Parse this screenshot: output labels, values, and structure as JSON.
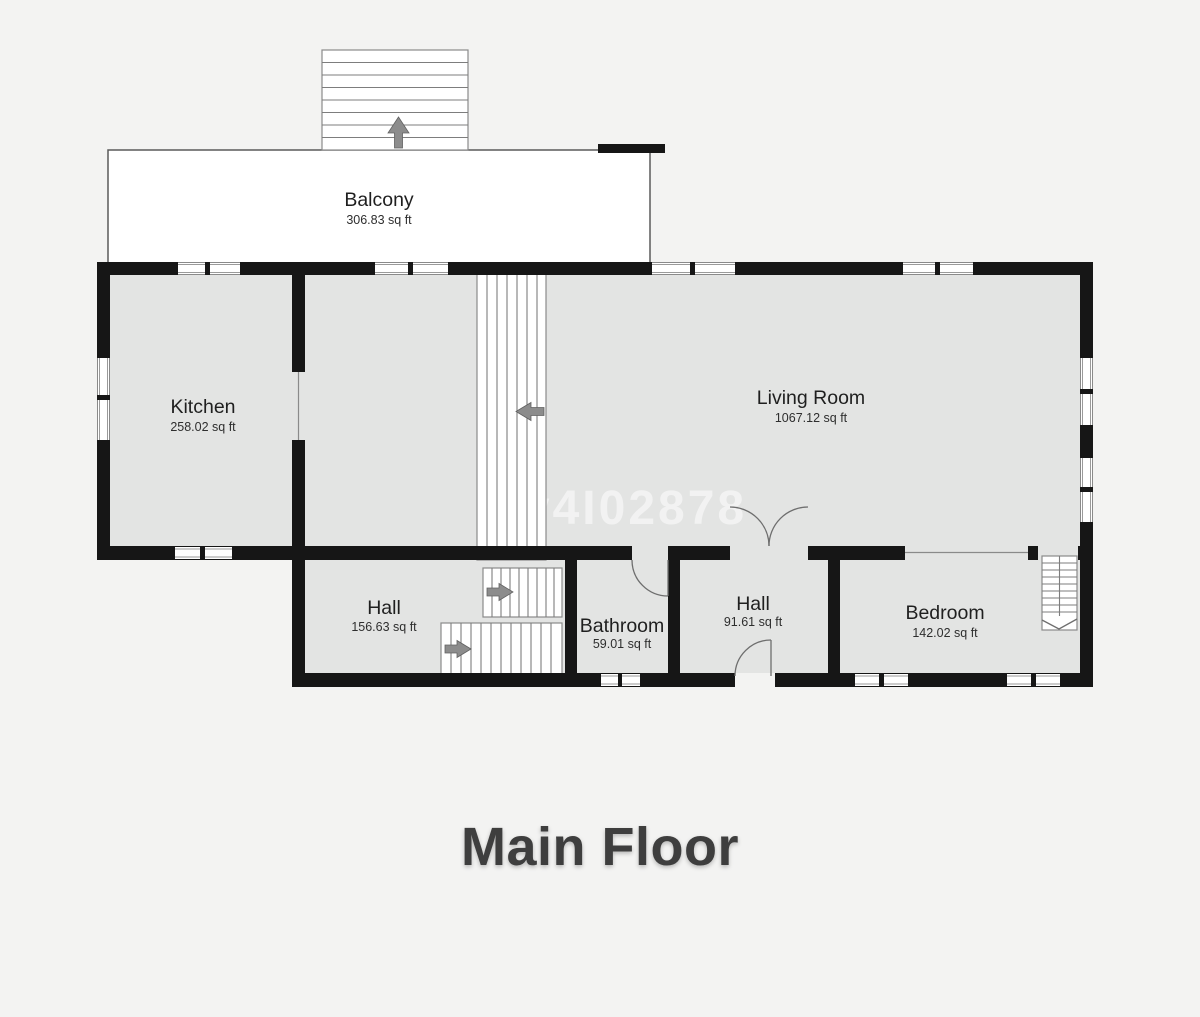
{
  "title": "Main Floor",
  "watermark": "v4I02878",
  "rooms": [
    {
      "name": "Balcony",
      "area": "306.83 sq ft"
    },
    {
      "name": "Kitchen",
      "area": "258.02 sq ft"
    },
    {
      "name": "Living Room",
      "area": "1067.12 sq ft"
    },
    {
      "name": "Hall",
      "area": "156.63 sq ft"
    },
    {
      "name": "Bathroom",
      "area": "59.01 sq ft"
    },
    {
      "name": "Hall",
      "area": "91.61 sq ft"
    },
    {
      "name": "Bedroom",
      "area": "142.02 sq ft"
    }
  ],
  "colors": {
    "background": "#f3f3f2",
    "floor": "#e3e4e3",
    "wall": "#161616",
    "stair_fill": "#ffffff",
    "arrow": "#8c8c8c",
    "watermark": "#ffffff",
    "title_text": "#3e3e3e"
  }
}
